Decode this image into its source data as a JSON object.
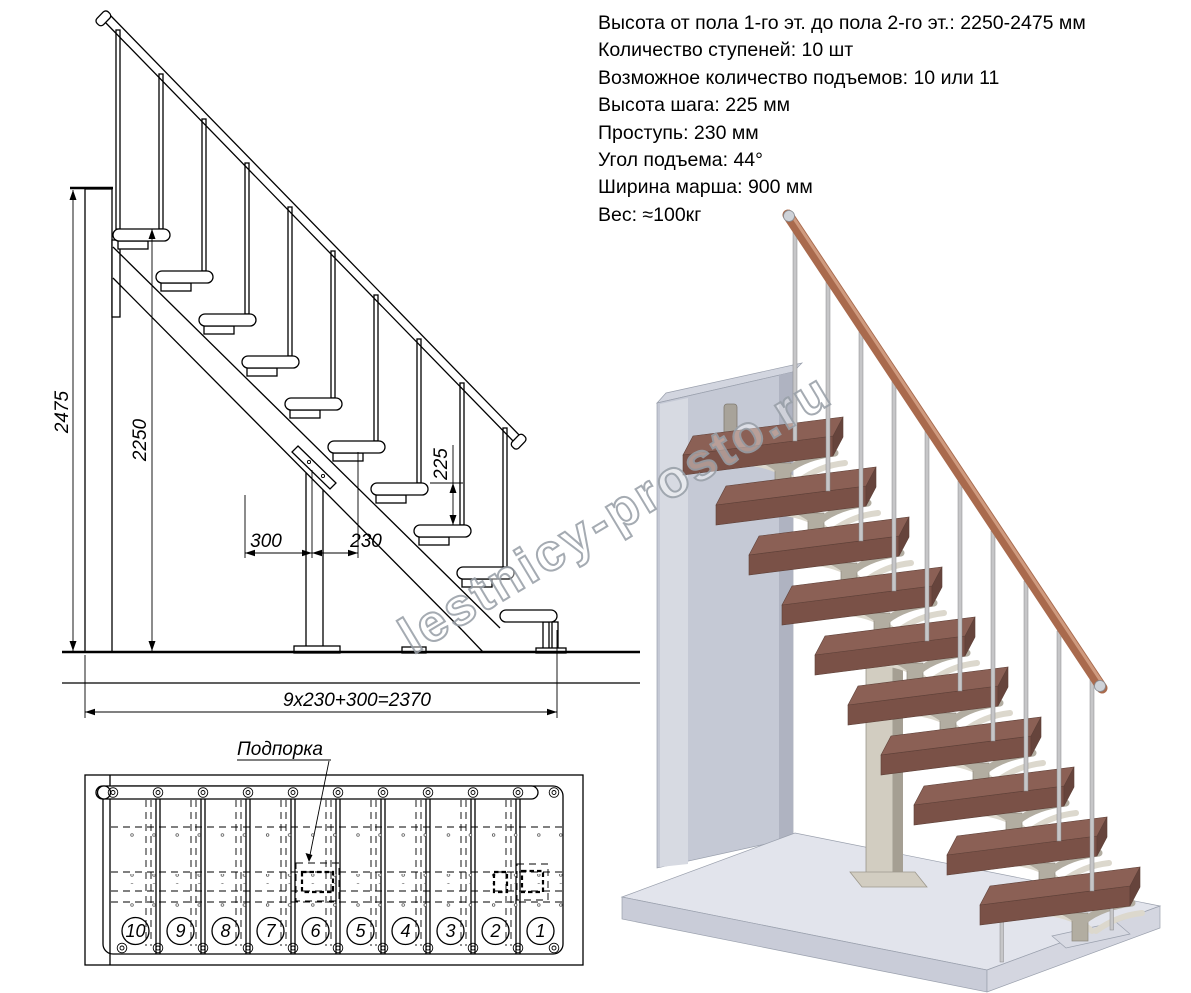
{
  "specs": {
    "lines": [
      "Высота от пола 1-го эт. до пола 2-го эт.: 2250-2475 мм",
      "Количество ступеней: 10 шт",
      "Возможное количество подъемов: 10 или 11",
      "Высота шага: 225 мм",
      "Проступь: 230 мм",
      "Угол подъема: 44°",
      "Ширина марша: 900 мм",
      "Вес: ≈100кг"
    ]
  },
  "elevation": {
    "dims": {
      "total_height": "2475",
      "flight_height": "2250",
      "step_rise": "225",
      "first_run": "300",
      "tread_run": "230",
      "total_run": "9x230+300=2370"
    }
  },
  "plan": {
    "support_label": "Подпорка",
    "step_numbers": [
      "10",
      "9",
      "8",
      "7",
      "6",
      "5",
      "4",
      "3",
      "2",
      "1"
    ]
  },
  "watermark": {
    "text": "lestnicy-prosto.ru"
  },
  "colors": {
    "line": "#000000",
    "tread_top": "#8b6055",
    "tread_front": "#7a5147",
    "tread_end": "#66443c",
    "wall_front": "#c5c9d5",
    "wall_side": "#d7dae2",
    "wall_top": "#d2d5df",
    "wall_edge": "#afb3c1",
    "slab_top": "#e2e4ec",
    "slab_front": "#c9ccd8",
    "slab_right": "#d4d6e0",
    "column": "#d2cdc1",
    "column_side": "#a59f93",
    "bracket": "#b2ada1",
    "bracket_light": "#dcd8cd",
    "baluster": "#c6c6c8",
    "rail": "#a96a4d",
    "rail_highlight": "#cf9a7e",
    "cap": "#ced2d8"
  }
}
